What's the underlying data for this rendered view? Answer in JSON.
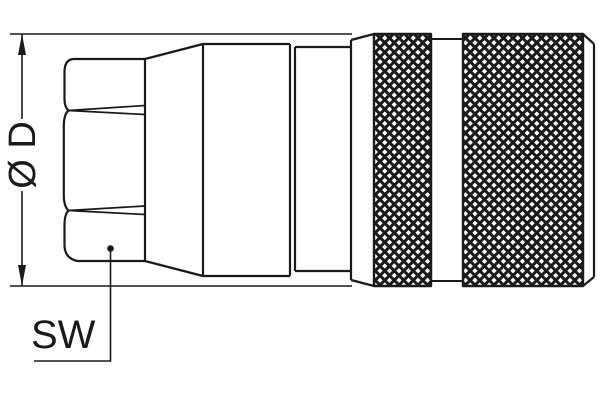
{
  "colors": {
    "line_color": "#1a1a1a",
    "background": "#ffffff"
  },
  "labels": {
    "diameter_dimension": "Ø D",
    "wrench_flat_callout": "SW"
  }
}
